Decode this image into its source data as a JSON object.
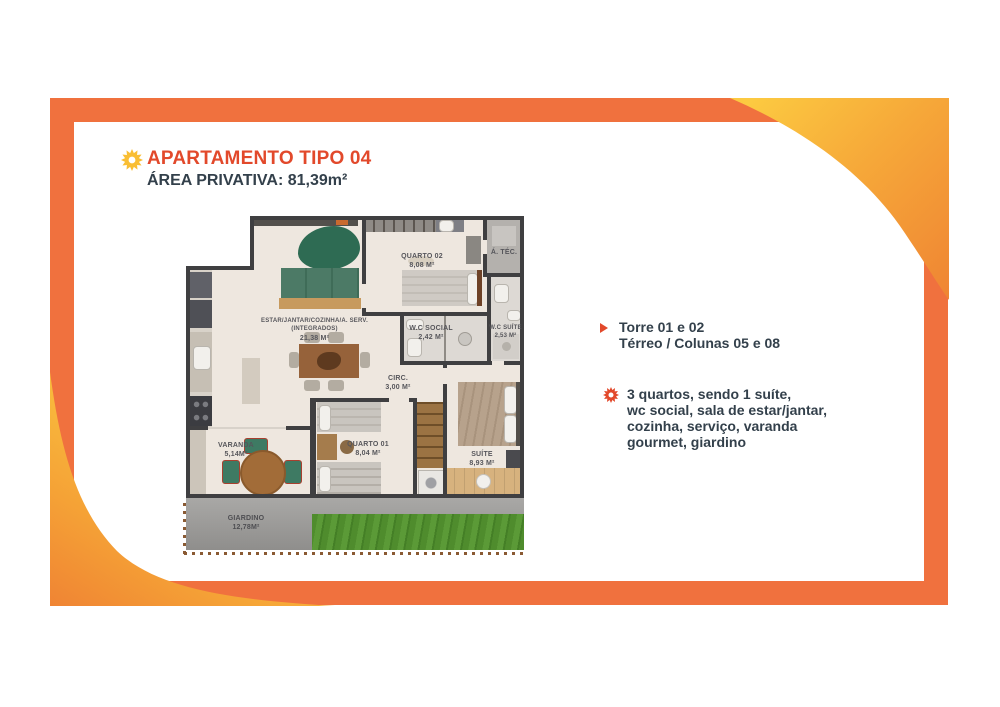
{
  "header": {
    "icon": "sun-icon",
    "icon_color": "#F9BE33",
    "title": "APARTAMENTO TIPO 04",
    "title_color": "#E2492B",
    "area_label": "ÁREA PRIVATIVA:",
    "area_value": "81,39m²",
    "text_color": "#33404B"
  },
  "frame": {
    "border_color": "#F0713E",
    "swoosh_yellow": "#FCCA41",
    "swoosh_orange": "#EF8433"
  },
  "floorplan": {
    "rooms": {
      "estar": {
        "name": "ESTAR/JANTAR/COZINHA/A. SERV.",
        "sub": "(INTEGRADOS)",
        "area": "21,38 M²"
      },
      "quarto02": {
        "name": "QUARTO 02",
        "area": "8,08 M²"
      },
      "atec": {
        "name": "Á. TÉC."
      },
      "wc_social": {
        "name": "W.C SOCIAL",
        "area": "2,42 M²"
      },
      "wc_suite": {
        "name": "W.C SUÍTE",
        "area": "2,53 M²"
      },
      "circ": {
        "name": "CIRC.",
        "area": "3,00 M²"
      },
      "quarto01": {
        "name": "QUARTO 01",
        "area": "8,04 M²"
      },
      "suite": {
        "name": "SUÍTE",
        "area": "8,93 M²"
      },
      "varanda": {
        "name": "VARANDA",
        "area": "5,14M²"
      },
      "giardino": {
        "name": "GIARDINO",
        "area": "12,78M²"
      }
    }
  },
  "details": {
    "location": {
      "bullet": "triangle-icon",
      "line1": "Torre 01 e 02",
      "line2": "Térreo / Colunas 05 e 08"
    },
    "features": {
      "bullet": "sun-icon",
      "lines": [
        "3 quartos, sendo 1 suíte,",
        "wc social, sala de estar/jantar,",
        "cozinha, serviço, varanda",
        "gourmet, giardino"
      ]
    }
  }
}
